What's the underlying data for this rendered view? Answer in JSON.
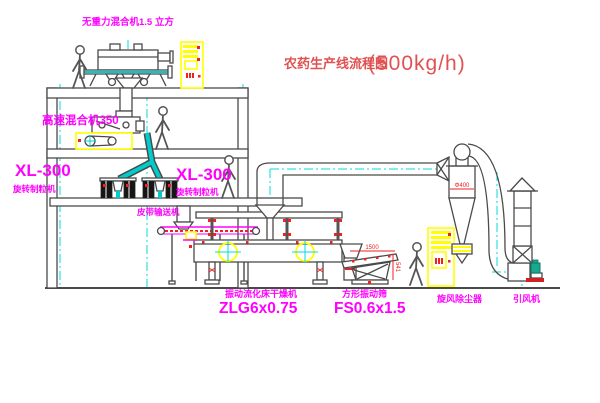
{
  "title": {
    "text_cn": "农药生产线流程图",
    "capacity": "(500kg/h)"
  },
  "labels": {
    "gravity_mixer": "无重力混合机1.5 立方",
    "high_speed_mixer": "高速混合机350",
    "granulator_left_model": "XL-300",
    "granulator_left_name": "旋转制粒机",
    "granulator_right_model": "XL-300",
    "granulator_right_name": "旋转制粒机",
    "belt_conveyor": "皮带输送机",
    "dryer_name": "振动流化床干燥机",
    "dryer_model": "ZLG6x0.75",
    "sieve_name": "方形振动筛",
    "sieve_model": "FS0.6x1.5",
    "cyclone_name": "旋风除尘器",
    "fan_name": "引风机"
  },
  "dimensions": {
    "sieve_length": "1500",
    "sieve_height": "541",
    "cyclone_diameter": "Φ400"
  },
  "colors": {
    "label_magenta": "#ff00ff",
    "title_red": "#e05252",
    "line_grey": "#4a4a4a",
    "highlight_yellow": "#ffff00",
    "centerline_cyan": "#00dddd",
    "accent_red": "#ee2222",
    "motor_teal": "#19a78f"
  }
}
